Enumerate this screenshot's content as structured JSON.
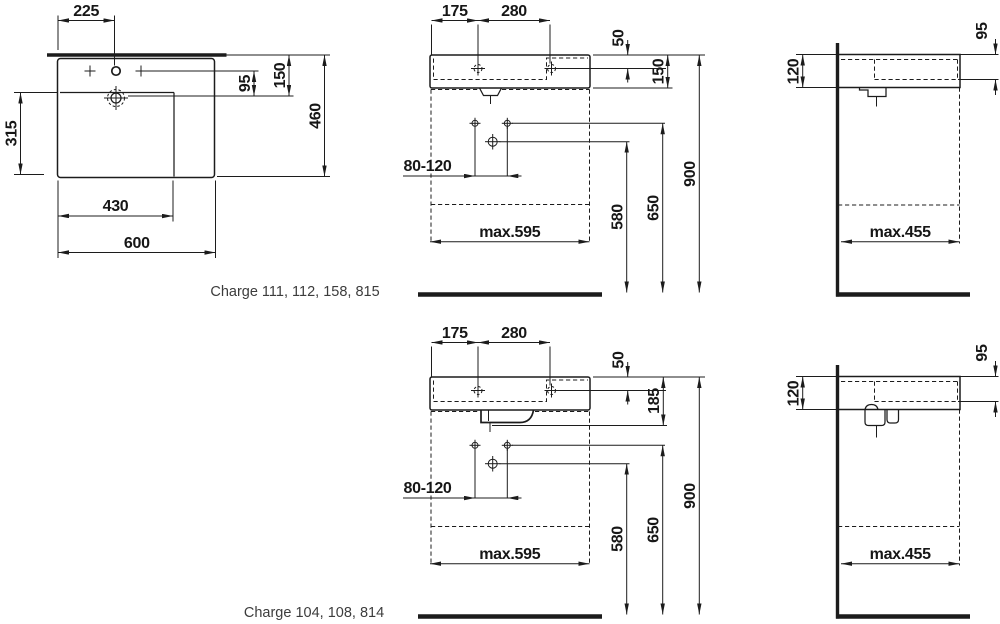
{
  "captions": {
    "group1": "Charge 111, 112, 158, 815",
    "group2": "Charge 104, 108, 814"
  },
  "plan_view": {
    "tap_from_left": "225",
    "tap_to_drain": "95",
    "back_to_drain": "150",
    "total_depth": "460",
    "bowl_depth": "315",
    "bowl_width": "430",
    "total_width": "600"
  },
  "front_view_top": {
    "left_to_tap": "175",
    "tap_spacing": "280",
    "top_to_tap": "50",
    "body_height": "150",
    "drain_offset_range": "80-120",
    "max_clearance_width": "max.595",
    "drain_outlet_height": "580",
    "fixing_height": "650",
    "rim_height": "900"
  },
  "side_view_top": {
    "body_height_at_wall": "120",
    "rim_to_bowl_depth": "95",
    "max_clearance_depth": "max.455"
  },
  "front_view_bottom": {
    "left_to_tap": "175",
    "tap_spacing": "280",
    "top_to_tap": "50",
    "body_height": "185",
    "drain_offset_range": "80-120",
    "max_clearance_width": "max.595",
    "drain_outlet_height": "580",
    "fixing_height": "650",
    "rim_height": "900"
  },
  "side_view_bottom": {
    "body_height_at_wall": "120",
    "rim_to_bowl_depth": "95",
    "max_clearance_depth": "max.455"
  }
}
